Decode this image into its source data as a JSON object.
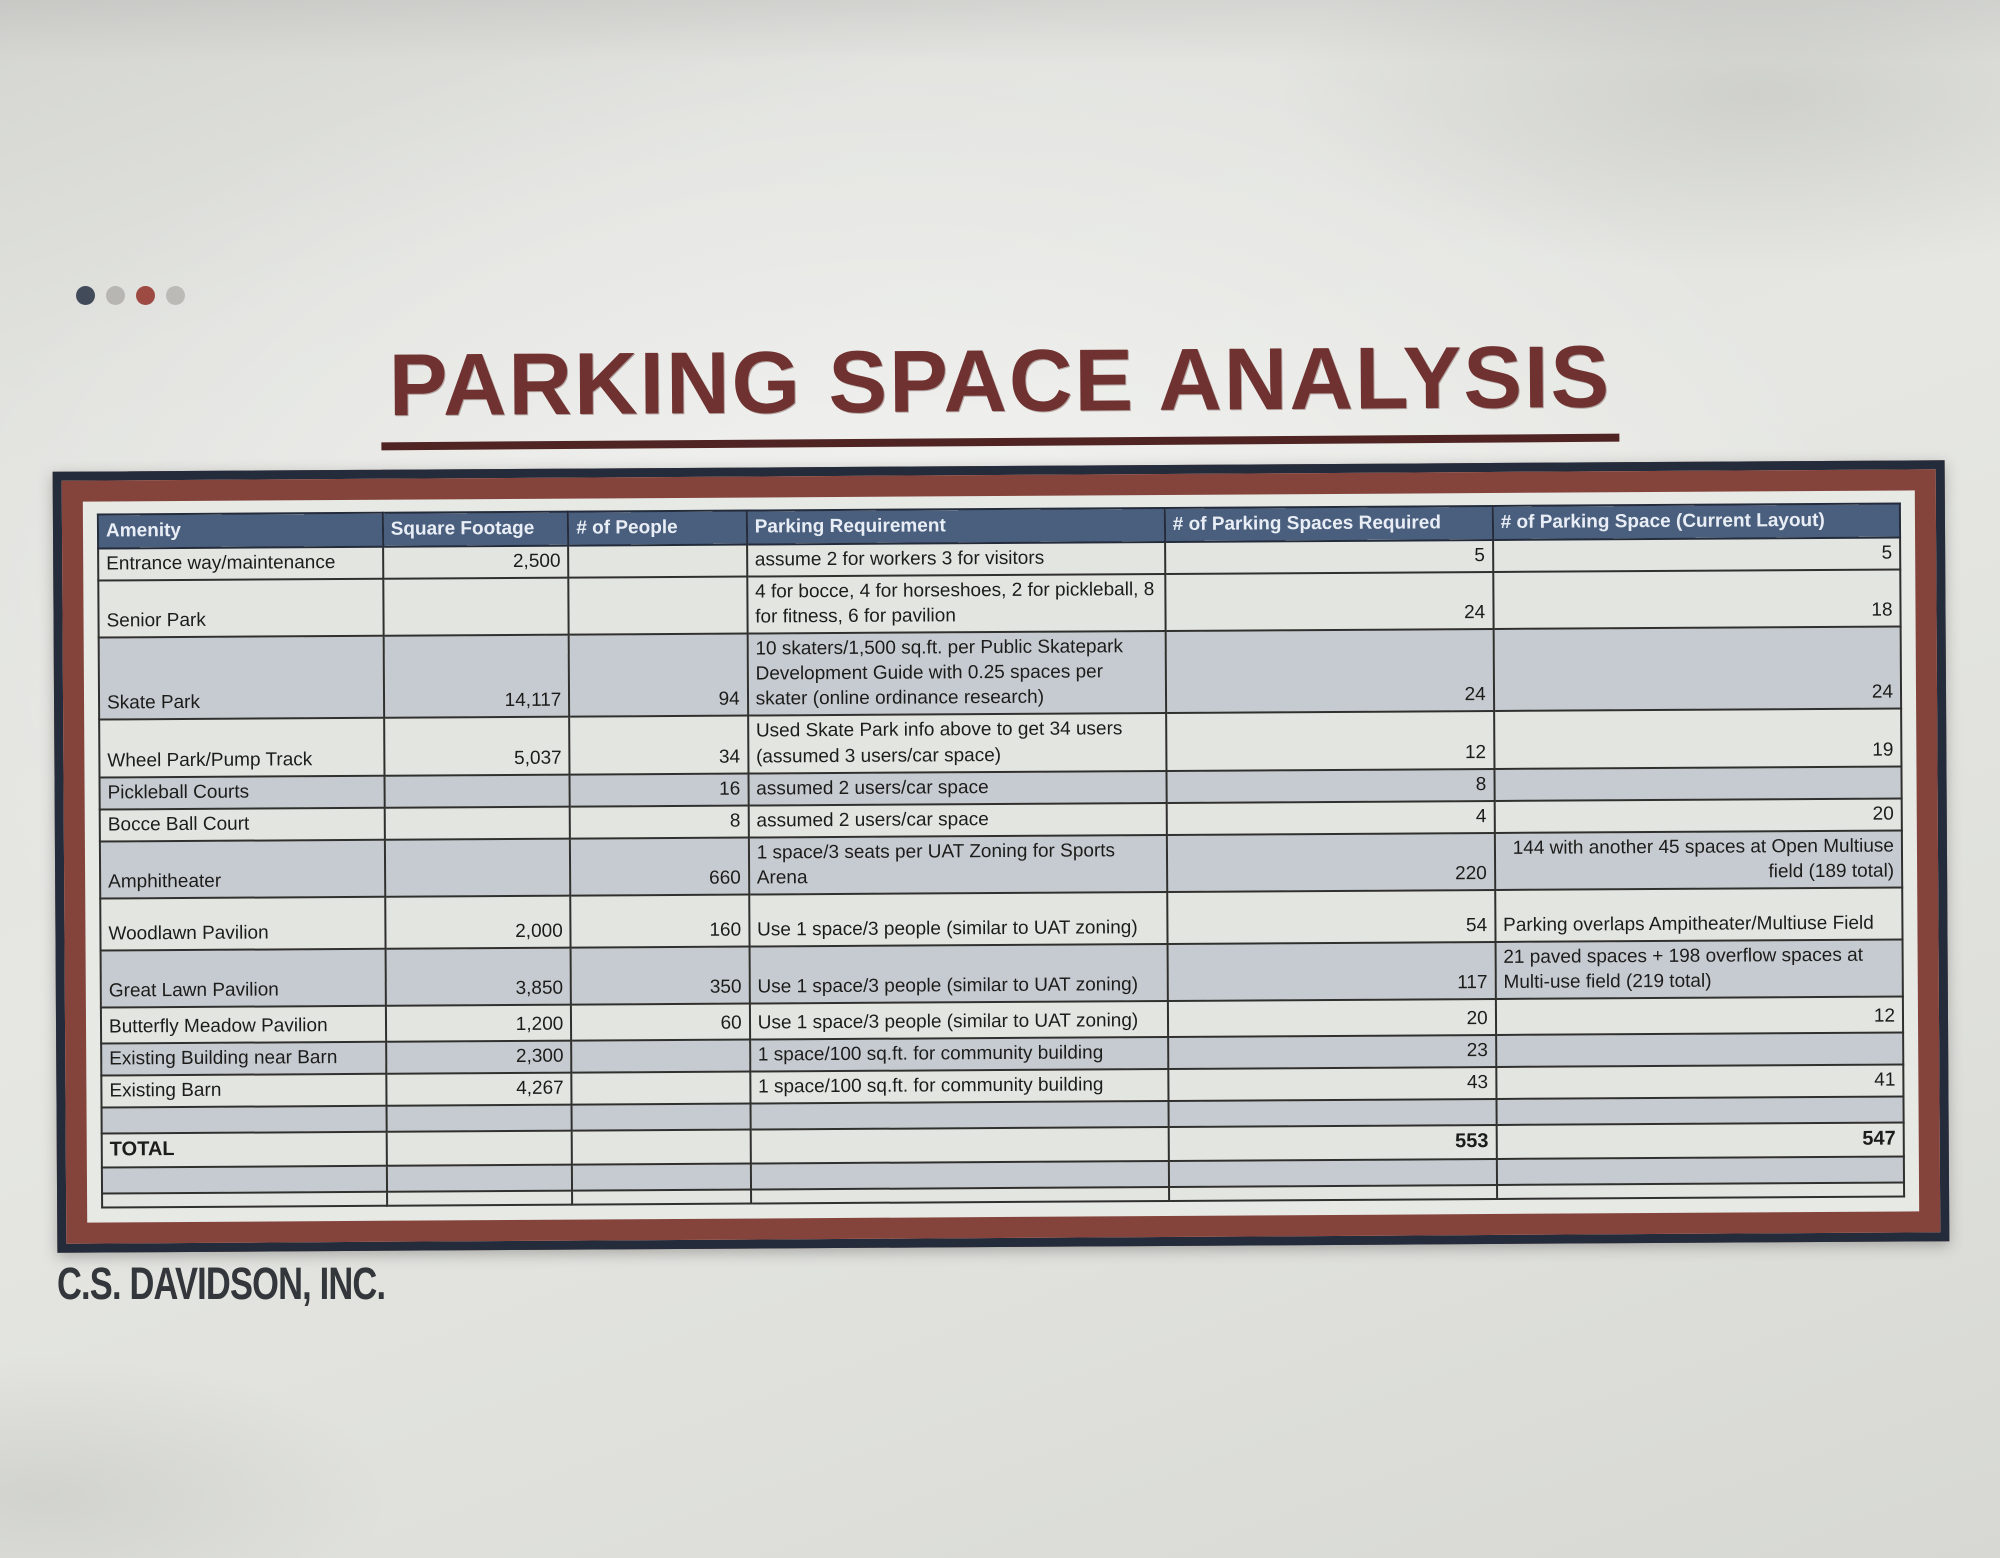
{
  "page": {
    "title": "PARKING SPACE ANALYSIS",
    "footer_logo": "C.S. DAVIDSON, INC."
  },
  "colors": {
    "title_text": "#703230",
    "header_bg": "#4a5f7d",
    "header_text": "#e9eef6",
    "frame_outer_navy": "#242c3c",
    "frame_inner_maroon": "#84443c",
    "row_light": "#e3e5e1",
    "row_shaded": "#c6cbd1",
    "grid_line": "#30302e",
    "dot_colors": [
      "#414b5a",
      "#b8b6b3",
      "#9d4a42",
      "#bcbab7"
    ]
  },
  "table": {
    "columns": [
      "Amenity",
      "Square Footage",
      "# of People",
      "Parking Requirement",
      "# of Parking Spaces Required",
      "# of Parking Space (Current Layout)"
    ],
    "rows": [
      {
        "amenity": "Entrance way/maintenance",
        "sqft": "2,500",
        "people": "",
        "requirement": "assume 2 for workers 3 for visitors",
        "required": "5",
        "current": "5"
      },
      {
        "amenity": "Senior Park",
        "sqft": "",
        "people": "",
        "requirement": "4 for bocce, 4 for horseshoes, 2 for pickleball, 8 for fitness, 6 for pavilion",
        "required": "24",
        "current": "18"
      },
      {
        "amenity": "Skate Park",
        "sqft": "14,117",
        "people": "94",
        "requirement": "10 skaters/1,500 sq.ft. per Public Skatepark Development Guide with 0.25 spaces per skater (online ordinance research)",
        "required": "24",
        "current": "24"
      },
      {
        "amenity": "Wheel Park/Pump Track",
        "sqft": "5,037",
        "people": "34",
        "requirement": "Used Skate Park info above to get 34 users (assumed 3 users/car space)",
        "required": "12",
        "current": "19"
      },
      {
        "amenity": "Pickleball Courts",
        "sqft": "",
        "people": "16",
        "requirement": "assumed 2 users/car space",
        "required": "8",
        "current": ""
      },
      {
        "amenity": "Bocce Ball Court",
        "sqft": "",
        "people": "8",
        "requirement": "assumed 2 users/car space",
        "required": "4",
        "current": "20"
      },
      {
        "amenity": "Amphitheater",
        "sqft": "",
        "people": "660",
        "requirement": "1 space/3 seats per UAT Zoning for Sports Arena",
        "required": "220",
        "current": "144 with another 45 spaces at Open Multiuse field (189 total)"
      },
      {
        "amenity": "Woodlawn Pavilion",
        "sqft": "2,000",
        "people": "160",
        "requirement": "Use 1 space/3 people (similar to UAT zoning)",
        "required": "54",
        "current": "Parking overlaps Ampitheater/Multiuse Field"
      },
      {
        "amenity": "Great Lawn Pavilion",
        "sqft": "3,850",
        "people": "350",
        "requirement": "Use 1 space/3 people (similar to UAT zoning)",
        "required": "117",
        "current": "21 paved spaces + 198 overflow spaces at Multi-use field (219 total)"
      },
      {
        "amenity": "Butterfly Meadow Pavilion",
        "sqft": "1,200",
        "people": "60",
        "requirement": "Use 1 space/3 people (similar to UAT zoning)",
        "required": "20",
        "current": "12"
      },
      {
        "amenity": "Existing Building near Barn",
        "sqft": "2,300",
        "people": "",
        "requirement": "1 space/100 sq.ft. for community building",
        "required": "23",
        "current": ""
      },
      {
        "amenity": "Existing Barn",
        "sqft": "4,267",
        "people": "",
        "requirement": "1 space/100 sq.ft. for community building",
        "required": "43",
        "current": "41"
      },
      {
        "amenity": "",
        "sqft": "",
        "people": "",
        "requirement": "",
        "required": "",
        "current": ""
      },
      {
        "amenity": "TOTAL",
        "sqft": "",
        "people": "",
        "requirement": "",
        "required": "553",
        "current": "547"
      },
      {
        "amenity": "",
        "sqft": "",
        "people": "",
        "requirement": "",
        "required": "",
        "current": ""
      },
      {
        "amenity": "",
        "sqft": "",
        "people": "",
        "requirement": "",
        "required": "",
        "current": ""
      }
    ]
  }
}
